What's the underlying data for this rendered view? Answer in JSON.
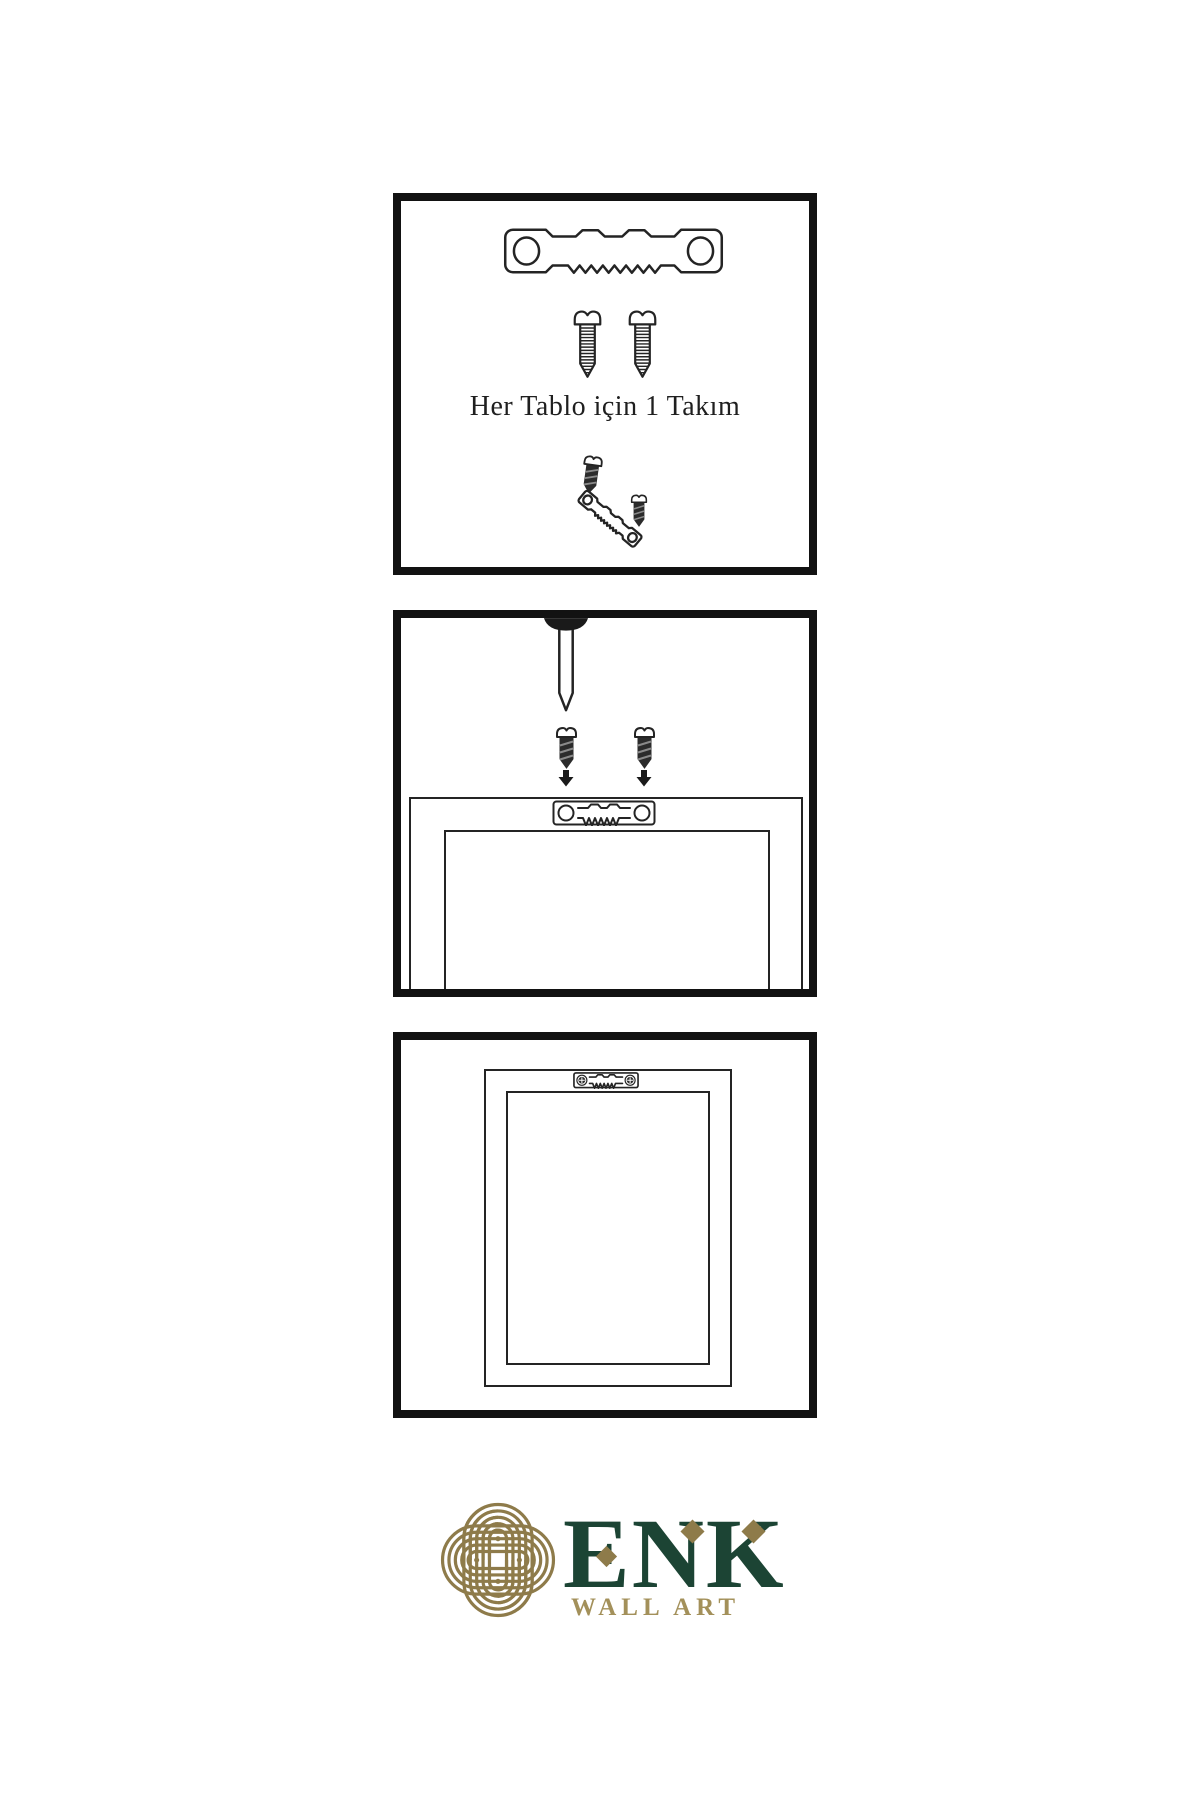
{
  "page": {
    "background": "#ffffff",
    "ink": "#242424",
    "panel_border": "#121212"
  },
  "steps": [
    {
      "id": 1,
      "caption": "Her Tablo için 1 Takım",
      "items": [
        "sawtooth-hanger",
        "screw",
        "screw",
        "screw-into-tilted-hanger"
      ]
    },
    {
      "id": 2,
      "items": [
        "nail",
        "dark-screw",
        "dark-screw",
        "down-arrow",
        "down-arrow",
        "sawtooth-hanger-on-frame-back"
      ]
    },
    {
      "id": 3,
      "items": [
        "frame-back-hung",
        "mounted-sawtooth-hanger-with-screws"
      ]
    }
  ],
  "logo": {
    "brand": "ENK",
    "subtitle": "WALL ART",
    "icon": "knot-icon",
    "colors": {
      "brand_green": "#1c4434",
      "knot_gold": "#8e7b4a",
      "subtitle_gold": "#a3905a"
    }
  }
}
